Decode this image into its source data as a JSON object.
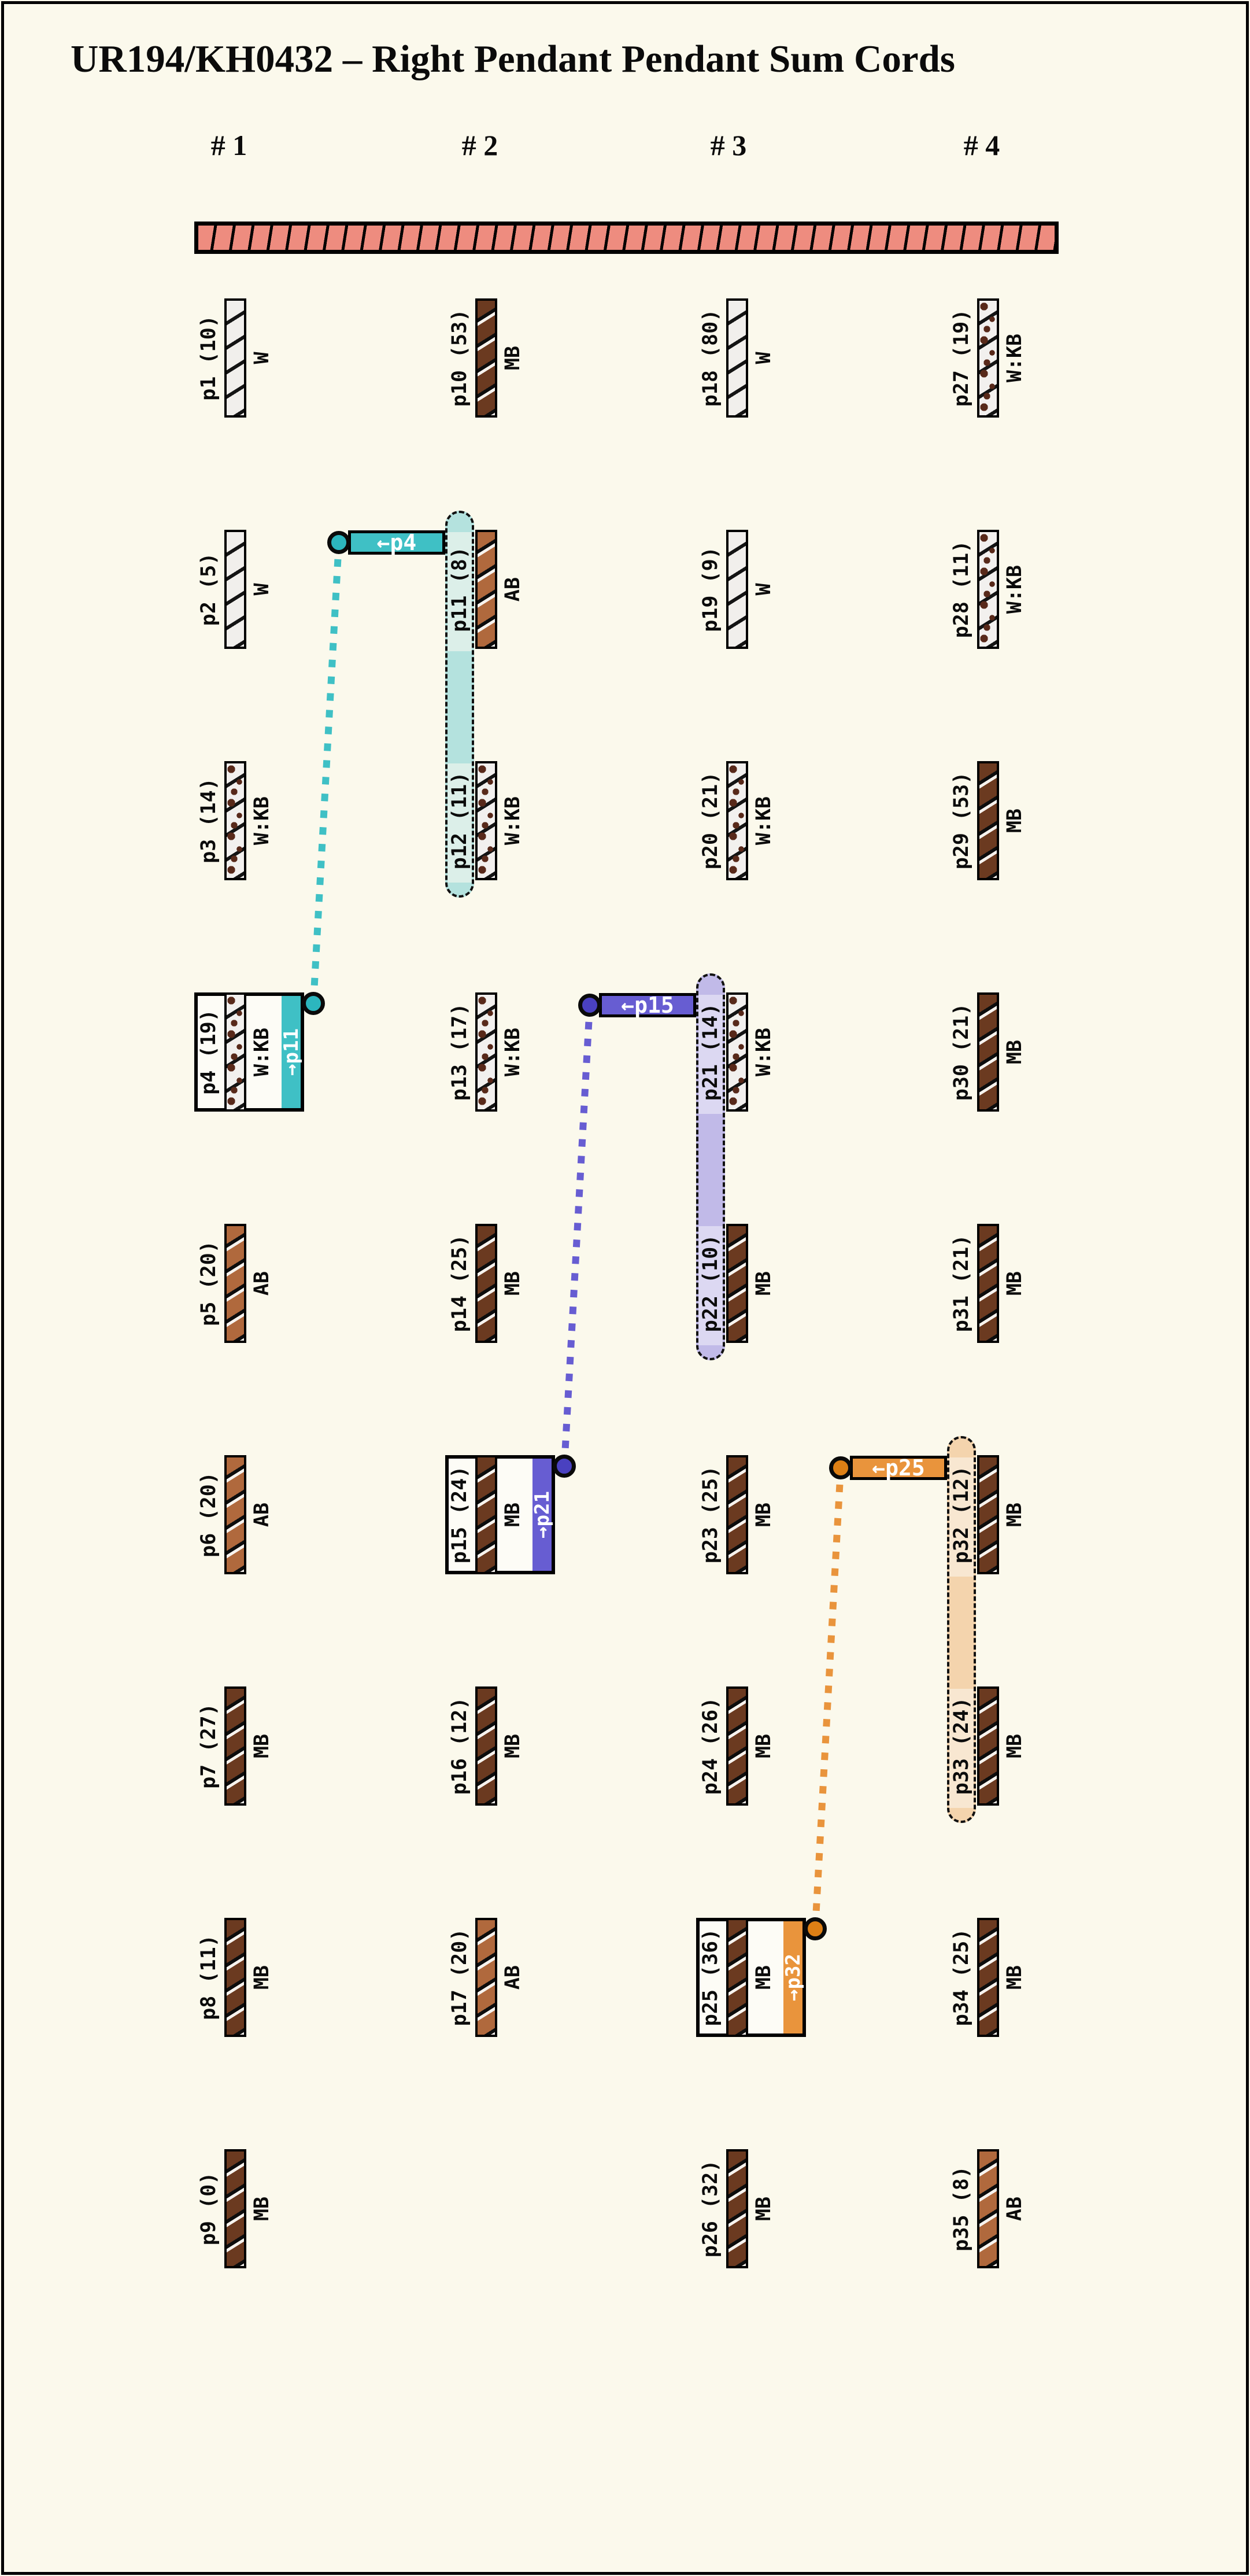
{
  "title": "UR194/KH0432 – Right Pendant Pendant Sum Cords",
  "groups": [
    "# 1",
    "# 2",
    "# 3",
    "# 4"
  ],
  "primary_cord": {
    "color": "#ee8c7f"
  },
  "background_color": "#fbf9ec",
  "cord_colors": {
    "W": {
      "name": "White",
      "hex": "#f1efec"
    },
    "MB": {
      "name": "Medium Brown",
      "hex": "#6b3a20"
    },
    "AB": {
      "name": "Auburn Brown",
      "hex": "#b0693d"
    },
    "W:KB": {
      "name": "White mottled Khaki Brown",
      "hex": "#f2f0ee"
    }
  },
  "pendants": [
    {
      "id": "p1",
      "label": "p1 (10)",
      "value": 10,
      "code": "W",
      "group": 1,
      "row": 1,
      "boxed": false
    },
    {
      "id": "p2",
      "label": "p2 (5)",
      "value": 5,
      "code": "W",
      "group": 1,
      "row": 2,
      "boxed": false
    },
    {
      "id": "p3",
      "label": "p3 (14)",
      "value": 14,
      "code": "W:KB",
      "group": 1,
      "row": 3,
      "boxed": false
    },
    {
      "id": "p4",
      "label": "p4 (19)",
      "value": 19,
      "code": "W:KB",
      "group": 1,
      "row": 4,
      "boxed": true
    },
    {
      "id": "p5",
      "label": "p5 (20)",
      "value": 20,
      "code": "AB",
      "group": 1,
      "row": 5,
      "boxed": false
    },
    {
      "id": "p6",
      "label": "p6 (20)",
      "value": 20,
      "code": "AB",
      "group": 1,
      "row": 6,
      "boxed": false
    },
    {
      "id": "p7",
      "label": "p7 (27)",
      "value": 27,
      "code": "MB",
      "group": 1,
      "row": 7,
      "boxed": false
    },
    {
      "id": "p8",
      "label": "p8 (11)",
      "value": 11,
      "code": "MB",
      "group": 1,
      "row": 8,
      "boxed": false
    },
    {
      "id": "p9",
      "label": "p9 (0)",
      "value": 0,
      "code": "MB",
      "group": 1,
      "row": 9,
      "boxed": false
    },
    {
      "id": "p10",
      "label": "p10 (53)",
      "value": 53,
      "code": "MB",
      "group": 2,
      "row": 1,
      "boxed": false
    },
    {
      "id": "p11",
      "label": "p11 (8)",
      "value": 8,
      "code": "AB",
      "group": 2,
      "row": 2,
      "boxed": false
    },
    {
      "id": "p12",
      "label": "p12 (11)",
      "value": 11,
      "code": "W:KB",
      "group": 2,
      "row": 3,
      "boxed": false
    },
    {
      "id": "p13",
      "label": "p13 (17)",
      "value": 17,
      "code": "W:KB",
      "group": 2,
      "row": 4,
      "boxed": false
    },
    {
      "id": "p14",
      "label": "p14 (25)",
      "value": 25,
      "code": "MB",
      "group": 2,
      "row": 5,
      "boxed": false
    },
    {
      "id": "p15",
      "label": "p15 (24)",
      "value": 24,
      "code": "MB",
      "group": 2,
      "row": 6,
      "boxed": true
    },
    {
      "id": "p16",
      "label": "p16 (12)",
      "value": 12,
      "code": "MB",
      "group": 2,
      "row": 7,
      "boxed": false
    },
    {
      "id": "p17",
      "label": "p17 (20)",
      "value": 20,
      "code": "AB",
      "group": 2,
      "row": 8,
      "boxed": false
    },
    {
      "id": "p18",
      "label": "p18 (80)",
      "value": 80,
      "code": "W",
      "group": 3,
      "row": 1,
      "boxed": false
    },
    {
      "id": "p19",
      "label": "p19 (9)",
      "value": 9,
      "code": "W",
      "group": 3,
      "row": 2,
      "boxed": false
    },
    {
      "id": "p20",
      "label": "p20 (21)",
      "value": 21,
      "code": "W:KB",
      "group": 3,
      "row": 3,
      "boxed": false
    },
    {
      "id": "p21",
      "label": "p21 (14)",
      "value": 14,
      "code": "W:KB",
      "group": 3,
      "row": 4,
      "boxed": false
    },
    {
      "id": "p22",
      "label": "p22 (10)",
      "value": 10,
      "code": "MB",
      "group": 3,
      "row": 5,
      "boxed": false
    },
    {
      "id": "p23",
      "label": "p23 (25)",
      "value": 25,
      "code": "MB",
      "group": 3,
      "row": 6,
      "boxed": false
    },
    {
      "id": "p24",
      "label": "p24 (26)",
      "value": 26,
      "code": "MB",
      "group": 3,
      "row": 7,
      "boxed": false
    },
    {
      "id": "p25",
      "label": "p25 (36)",
      "value": 36,
      "code": "MB",
      "group": 3,
      "row": 8,
      "boxed": true
    },
    {
      "id": "p26",
      "label": "p26 (32)",
      "value": 32,
      "code": "MB",
      "group": 3,
      "row": 9,
      "boxed": false
    },
    {
      "id": "p27",
      "label": "p27 (19)",
      "value": 19,
      "code": "W:KB",
      "group": 4,
      "row": 1,
      "boxed": false
    },
    {
      "id": "p28",
      "label": "p28 (11)",
      "value": 11,
      "code": "W:KB",
      "group": 4,
      "row": 2,
      "boxed": false
    },
    {
      "id": "p29",
      "label": "p29 (53)",
      "value": 53,
      "code": "MB",
      "group": 4,
      "row": 3,
      "boxed": false
    },
    {
      "id": "p30",
      "label": "p30 (21)",
      "value": 21,
      "code": "MB",
      "group": 4,
      "row": 4,
      "boxed": false
    },
    {
      "id": "p31",
      "label": "p31 (21)",
      "value": 21,
      "code": "MB",
      "group": 4,
      "row": 5,
      "boxed": false
    },
    {
      "id": "p32",
      "label": "p32 (12)",
      "value": 12,
      "code": "MB",
      "group": 4,
      "row": 6,
      "boxed": false
    },
    {
      "id": "p33",
      "label": "p33 (24)",
      "value": 24,
      "code": "MB",
      "group": 4,
      "row": 7,
      "boxed": false
    },
    {
      "id": "p34",
      "label": "p34 (25)",
      "value": 25,
      "code": "MB",
      "group": 4,
      "row": 8,
      "boxed": false
    },
    {
      "id": "p35",
      "label": "p35 (8)",
      "value": 8,
      "code": "AB",
      "group": 4,
      "row": 9,
      "boxed": false
    }
  ],
  "links": [
    {
      "source": "p4",
      "source_group": 1,
      "source_row": 4,
      "source_label": "→p11",
      "connector_label": "←p4",
      "targets": [
        "p11",
        "p12"
      ],
      "target_group": 2,
      "target_rows": [
        2,
        3
      ],
      "color": "#3fc0c5",
      "circle_color": "#2cb6be",
      "capsule_fill": "#b4e2de",
      "capsule_label_fill": "#dcefe9"
    },
    {
      "source": "p15",
      "source_group": 2,
      "source_row": 6,
      "source_label": "→p21",
      "connector_label": "←p15",
      "targets": [
        "p21",
        "p22"
      ],
      "target_group": 3,
      "target_rows": [
        4,
        5
      ],
      "color": "#675dd2",
      "circle_color": "#4a41c0",
      "capsule_fill": "#c1bae8",
      "capsule_label_fill": "#dcd8f2"
    },
    {
      "source": "p25",
      "source_group": 3,
      "source_row": 8,
      "source_label": "→p32",
      "connector_label": "←p25",
      "targets": [
        "p32",
        "p33"
      ],
      "target_group": 4,
      "target_rows": [
        6,
        7
      ],
      "color": "#e9943c",
      "circle_color": "#dd7f15",
      "capsule_fill": "#f4d4ad",
      "capsule_label_fill": "#f8e7d1"
    }
  ]
}
